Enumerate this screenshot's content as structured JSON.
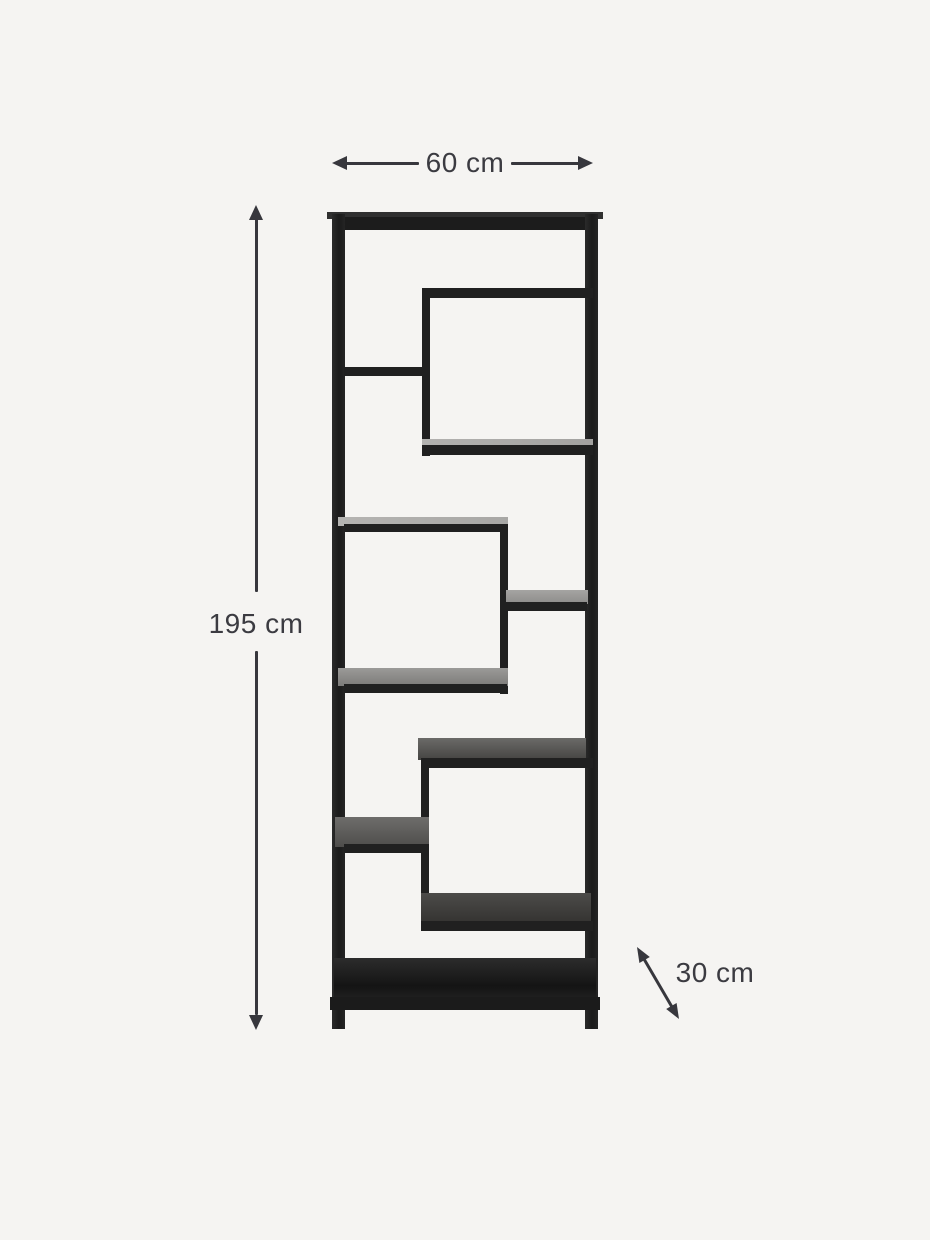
{
  "page": {
    "background_color": "#f5f4f2"
  },
  "product": {
    "name": "metal-shelf-unit",
    "frame_color": "#202020",
    "glass_shelf_light_color": "#b3b2b0",
    "glass_shelf_mid_color": "#8e8d8b",
    "glass_shelf_dark_color": "#1d1d1d"
  },
  "dimensions": {
    "annotation_color": "#37373d",
    "width": {
      "label": "60 cm"
    },
    "height": {
      "label": "195 cm"
    },
    "depth": {
      "label": "30 cm"
    }
  }
}
